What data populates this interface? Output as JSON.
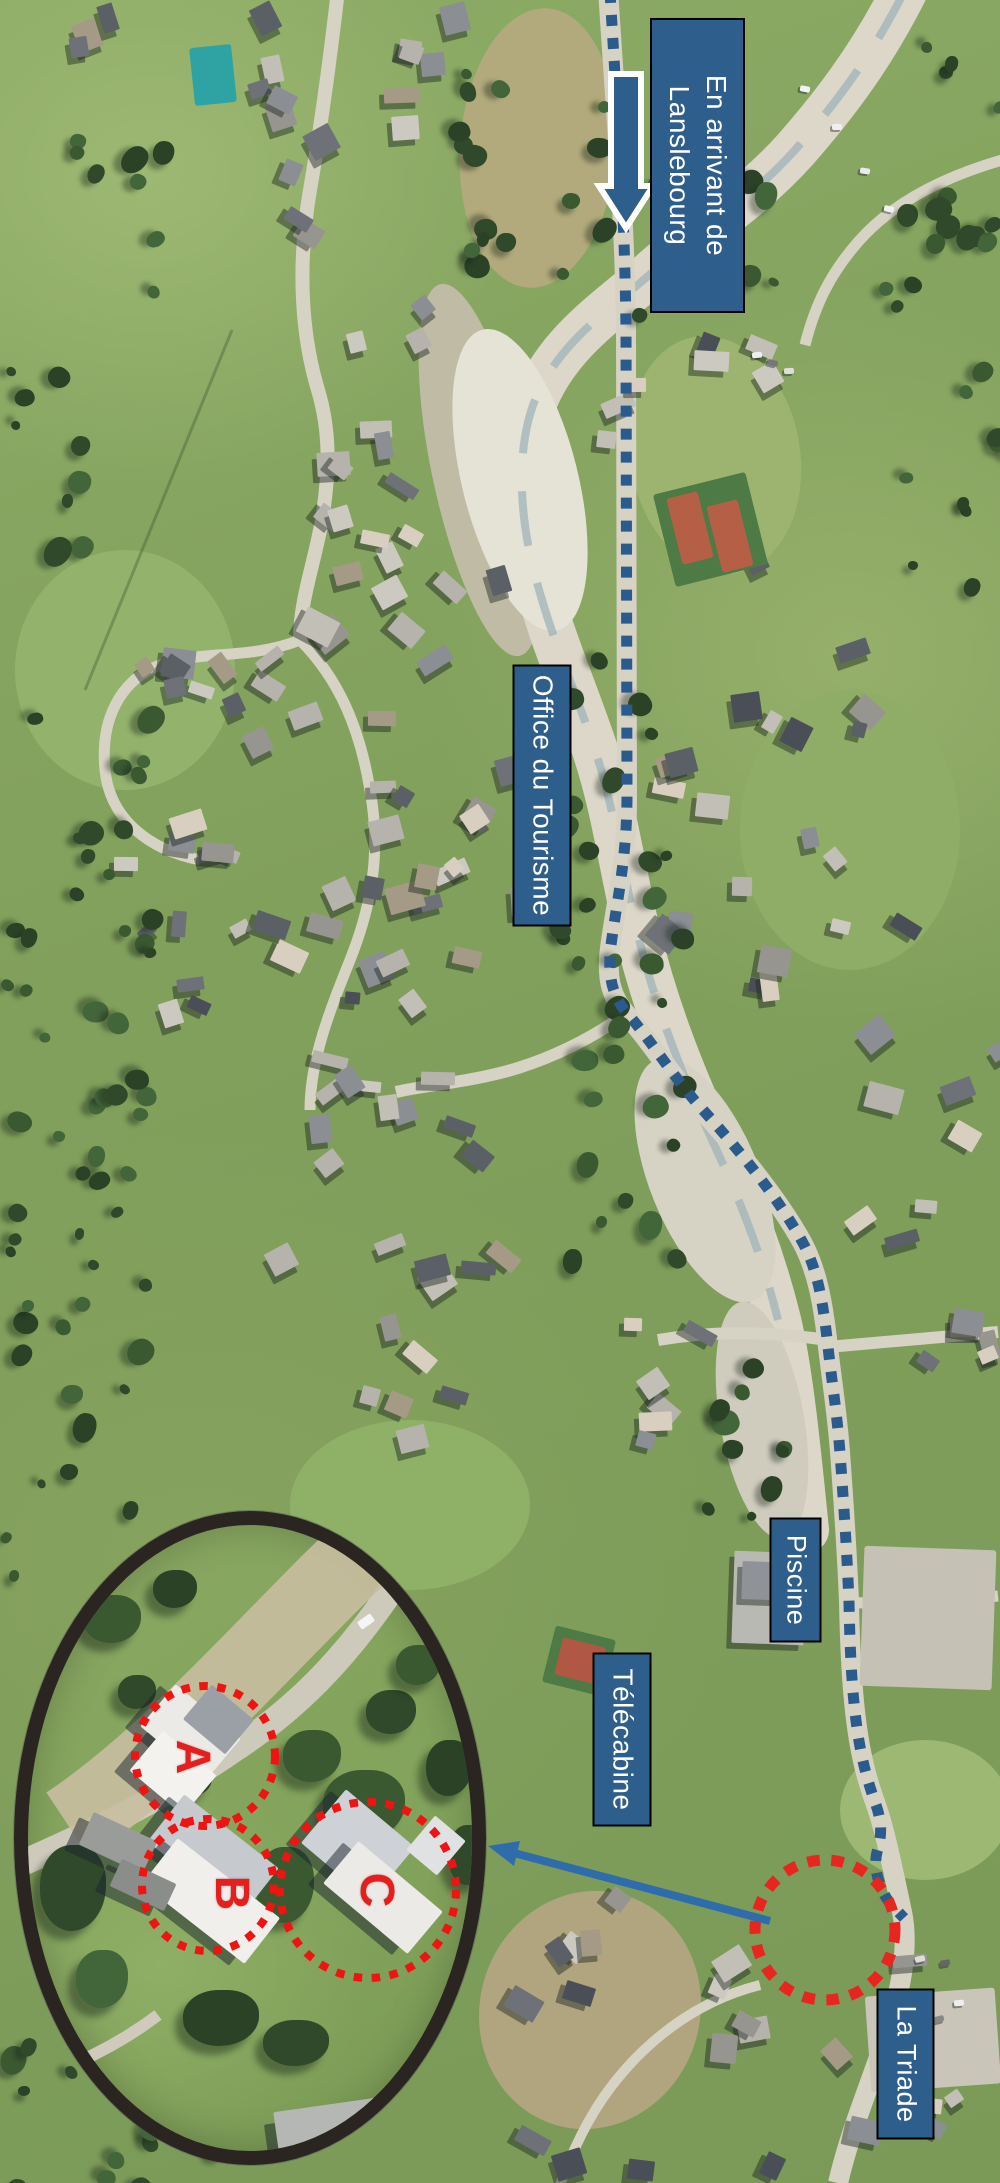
{
  "labels": {
    "arrival_line1": "En arrivant de",
    "arrival_line2": "Lanslebourg",
    "tourism": "Office du Tourisme",
    "piscine": "Piscine",
    "telecabine": "Télécabine",
    "triade": "La Triade"
  },
  "magnifier": {
    "label_a": "A",
    "label_b": "B",
    "label_c": "C"
  },
  "colors": {
    "label_background": "#2e5f8c",
    "label_text": "#ffffff",
    "route_dashes": "#2b5a8c",
    "arrival_arrow_fill": "#2e5f8c",
    "arrival_arrow_outline": "#ffffff",
    "highlight_red": "#e8251f",
    "magnifier_ring": "#2b2522",
    "connector_arrow": "#2f6cab"
  }
}
